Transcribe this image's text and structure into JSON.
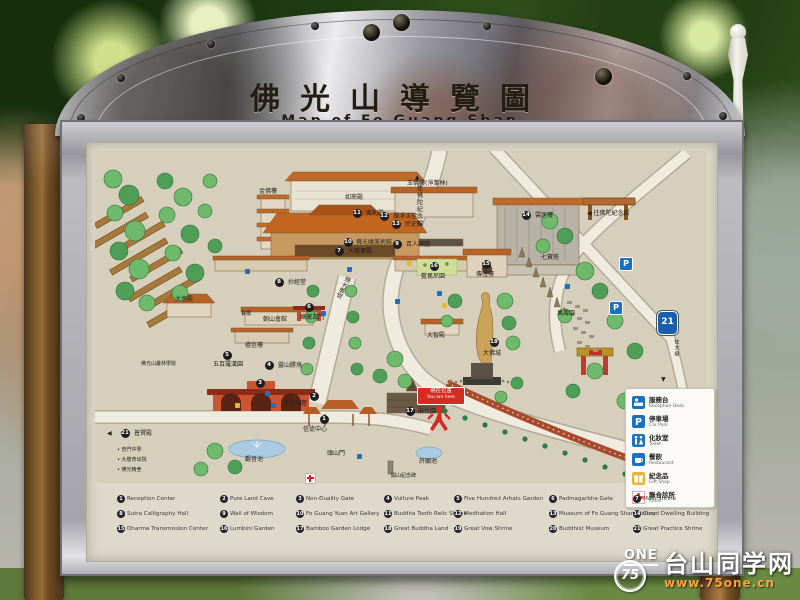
{
  "sign": {
    "title_zh": "佛光山導覽圖",
    "title_en": "Map of Fo Guang Shan"
  },
  "map": {
    "you_are_here": {
      "zh": "現在位置",
      "en": "You are here"
    },
    "route_shield": "21",
    "parking_letter": "P",
    "markers": [
      {
        "n": "1",
        "zh": "信徒中心",
        "x": 229,
        "y": 268,
        "lx": 208,
        "ly": 276
      },
      {
        "n": "2",
        "zh": "淨土洞窟",
        "x": 219,
        "y": 245,
        "lx": 188,
        "ly": 250
      },
      {
        "n": "3",
        "zh": "",
        "x": 165,
        "y": 232,
        "lx": 0,
        "ly": 0
      },
      {
        "n": "4",
        "zh": "靈山勝境",
        "x": 174,
        "y": 214,
        "lx": 183,
        "ly": 212
      },
      {
        "n": "5",
        "zh": "五百羅漢園",
        "x": 132,
        "y": 204,
        "lx": 118,
        "ly": 211
      },
      {
        "n": "6",
        "zh": "華藏玄門",
        "x": 214,
        "y": 156,
        "lx": 205,
        "ly": 164
      },
      {
        "n": "7",
        "zh": "大雄寶殿",
        "x": 244,
        "y": 100,
        "lx": 253,
        "ly": 98
      },
      {
        "n": "8",
        "zh": "抄經堂",
        "x": 184,
        "y": 131,
        "lx": 193,
        "ly": 129
      },
      {
        "n": "9",
        "zh": "百人碑牆",
        "x": 302,
        "y": 93,
        "lx": 311,
        "ly": 91
      },
      {
        "n": "10",
        "zh": "佛光緣美術館",
        "x": 253,
        "y": 91,
        "lx": 261,
        "ly": 89
      },
      {
        "n": "11",
        "zh": "舍利殿",
        "x": 262,
        "y": 62,
        "lx": 271,
        "ly": 60
      },
      {
        "n": "12",
        "zh": "禪淨法堂",
        "x": 289,
        "y": 65,
        "lx": 298,
        "ly": 63
      },
      {
        "n": "13",
        "zh": "宗史館",
        "x": 301,
        "y": 73,
        "lx": 310,
        "ly": 71
      },
      {
        "n": "14",
        "zh": "雲居樓",
        "x": 431,
        "y": 64,
        "lx": 440,
        "ly": 62
      },
      {
        "n": "15",
        "zh": "傳燈樓",
        "x": 391,
        "y": 113,
        "lx": 381,
        "ly": 121
      },
      {
        "n": "16",
        "zh": "藍毘尼園",
        "x": 339,
        "y": 115,
        "lx": 326,
        "ly": 123
      },
      {
        "n": "17",
        "zh": "麻竹園",
        "x": 315,
        "y": 260,
        "lx": 323,
        "ly": 258
      },
      {
        "n": "18",
        "zh": "大佛城",
        "x": 399,
        "y": 191,
        "lx": 388,
        "ly": 200
      },
      {
        "n": "21",
        "zh": "普賢殿",
        "x": 30,
        "y": 282,
        "lx": 39,
        "ly": 280
      }
    ],
    "labels": [
      {
        "t": "如來殿",
        "x": 250,
        "y": 44
      },
      {
        "t": "金佛樓",
        "x": 164,
        "y": 38
      },
      {
        "t": "玉佛樓(淨業林)",
        "x": 312,
        "y": 30
      },
      {
        "t": "大悲殿",
        "x": 80,
        "y": 146
      },
      {
        "t": "朝山會館",
        "x": 168,
        "y": 166
      },
      {
        "t": "檀信樓",
        "x": 150,
        "y": 192
      },
      {
        "t": "寶橋",
        "x": 146,
        "y": 160,
        "cls": "small"
      },
      {
        "t": "大智殿",
        "x": 332,
        "y": 182
      },
      {
        "t": "觀音池",
        "x": 150,
        "y": 306
      },
      {
        "t": "許願池",
        "x": 324,
        "y": 308
      },
      {
        "t": "開山紀念碑",
        "x": 296,
        "y": 322,
        "cls": "small"
      },
      {
        "t": "頭山門",
        "x": 232,
        "y": 300
      },
      {
        "t": "七寶塔",
        "x": 446,
        "y": 104
      },
      {
        "t": "萬壽園",
        "x": 462,
        "y": 160
      },
      {
        "t": "成佛大道",
        "x": 238,
        "y": 134,
        "rot": -63
      },
      {
        "t": "佛光山叢林學院",
        "x": 46,
        "y": 210,
        "cls": "small"
      },
      {
        "t": "▲",
        "x": 320,
        "y": 24
      },
      {
        "t": "往佛陀紀念館",
        "x": 320,
        "y": 34,
        "vert": true
      },
      {
        "t": "◀ 往佛陀紀念館",
        "x": 492,
        "y": 60
      },
      {
        "t": "往大樹",
        "x": 578,
        "y": 188,
        "vert": true,
        "cls": "small"
      },
      {
        "t": "▼",
        "x": 566,
        "y": 226
      },
      {
        "t": "◀",
        "x": 12,
        "y": 280
      },
      {
        "t": "• 普門中學",
        "x": 22,
        "y": 296,
        "cls": "small"
      },
      {
        "t": "• 大慈育幼院",
        "x": 22,
        "y": 306,
        "cls": "small"
      },
      {
        "t": "• 佛光精舍",
        "x": 22,
        "y": 316,
        "cls": "small"
      }
    ],
    "facility_legend": [
      {
        "icon": "desk",
        "zh": "服務台",
        "en": "Reception Desk"
      },
      {
        "icon": "parking",
        "zh": "停車場",
        "en": "Car Park"
      },
      {
        "icon": "toilet",
        "zh": "化妝室",
        "en": "Toilet"
      },
      {
        "icon": "restaurant",
        "zh": "餐飲",
        "en": "Restaurant"
      },
      {
        "icon": "gift",
        "zh": "紀念品",
        "en": "Gift Shop"
      },
      {
        "icon": "clinic",
        "zh": "聯合診所",
        "en": "Clinic"
      }
    ]
  },
  "legend": {
    "items": [
      "Reception Center",
      "Pure Land Cave",
      "Non-Duality Gate",
      "Vulture Peak",
      "Five Hundred Arhats Garden",
      "Padmagarbha Gate",
      "Main Shrine",
      "Sutra Calligraphy Hall",
      "Wall of Wisdom",
      "Fo Guang Yuan Art Gallery",
      "Buddha Tooth Relic Shrine",
      "Meditation Hall",
      "Museum of Fo Guang Shan History",
      "Cloud Dwelling Building",
      "Dharma Transmission Center",
      "Lumbini Garden",
      "Bamboo Garden Lodge",
      "Great Buddha Land",
      "Great Vow Shrine",
      "Buddhist Museum",
      "Great Practice Shrine"
    ]
  },
  "watermark": {
    "logo_top": "ONE",
    "logo_num": "75",
    "site_zh": "台山同学网",
    "site_url": "www.75one.cn"
  }
}
